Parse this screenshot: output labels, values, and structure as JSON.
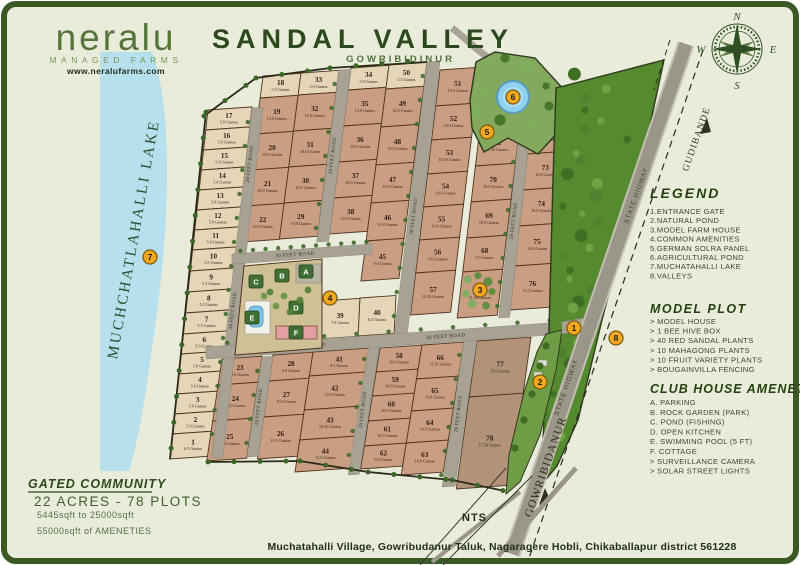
{
  "branding": {
    "logo": "neralu",
    "tagline": "MANAGED FARMS",
    "website": "www.neralufarms.com"
  },
  "header": {
    "title": "SANDAL VALLEY",
    "subtitle": "GOWRIBIDINUR"
  },
  "compass": {
    "n": "N",
    "e": "E",
    "s": "S",
    "w": "W"
  },
  "legend": {
    "heading": "LEGEND",
    "items": [
      "1.ENTRANCE GATE",
      "2.NATURAL POND",
      "3.MODEL FARM HOUSE",
      "4.COMMON AMENITIES",
      "5.GERMAN SOLRA PANEL",
      "6.AGRICULTURAL POND",
      "7.MUCHATAHALLI LAKE",
      "8.VALLEYS"
    ]
  },
  "model_plot": {
    "heading": "MODEL PLOT",
    "items": [
      "> MODEL HOUSE",
      "> 1 BEE HIVE BOX",
      "> 40 RED SANDAL PLANTS",
      "> 10 MAHAGONG PLANTS",
      "> 10 FRUIT VARIETY PLANTS",
      "> BOUGAINVILLA FENCING"
    ]
  },
  "club_house": {
    "heading": "CLUB HOUSE AMENETIES",
    "items": [
      "A. PARKING",
      "B. ROCK GARDEN (PARK)",
      "C. POND (FISHING)",
      "D. OPEN KITCHEN",
      "E. SWIMMING POOL (5 FT)",
      "F. COTTAGE",
      "> SURVEILLANCE CAMERA",
      "> SOLAR STREET LIGHTS"
    ]
  },
  "summary": {
    "heading": "GATED COMMUNITY",
    "line1": "22 ACRES - 78 PLOTS",
    "line2": "5445sqft to 25000sqft",
    "line3": "55000sqft of AMENETIES"
  },
  "footer": {
    "address": "Muchatahalli Village, Gowribudanur Taluk, Nagaragere Hobli, Chikaballapur district 561228"
  },
  "map": {
    "scale_note": "NTS",
    "lake_label": "MUCHCHATLAHALLI LAKE",
    "guntas_suffix": "Guntas",
    "road_labels": {
      "gudibande": "GUDIBANDE",
      "gowribidanur": "GOWRIBIDANUR",
      "state_highway": "STATE HIGWAY"
    },
    "colors": {
      "light": "#e6d6b8",
      "salmon": "#c99e83",
      "brown": "#b29377",
      "road": "#a8a294",
      "lake": "#b7e0ee",
      "forest": "#568a2e",
      "pond_green": "#85a95c",
      "marker": "#f4a81d",
      "border": "#3b5a23"
    },
    "markers": [
      {
        "n": "1",
        "x": 574,
        "y": 328
      },
      {
        "n": "2",
        "x": 540,
        "y": 382
      },
      {
        "n": "3",
        "x": 480,
        "y": 290
      },
      {
        "n": "4",
        "x": 330,
        "y": 298
      },
      {
        "n": "5",
        "x": 487,
        "y": 132
      },
      {
        "n": "6",
        "x": 513,
        "y": 97
      },
      {
        "n": "7",
        "x": 150,
        "y": 257
      },
      {
        "n": "8",
        "x": 616,
        "y": 338
      }
    ],
    "amenity_blocks": [
      {
        "l": "C",
        "x": 256,
        "y": 282
      },
      {
        "l": "B",
        "x": 282,
        "y": 276
      },
      {
        "l": "A",
        "x": 306,
        "y": 272
      },
      {
        "l": "D",
        "x": 296,
        "y": 308
      },
      {
        "l": "E",
        "x": 252,
        "y": 318
      },
      {
        "l": "F",
        "x": 296,
        "y": 333
      }
    ],
    "columns": [
      {
        "x": 208,
        "y": 110,
        "w": 44,
        "lean": -0.11,
        "c": "light",
        "plots": [
          {
            "n": "17",
            "g": "5.0",
            "h": 20
          },
          {
            "n": "16",
            "g": "5.0",
            "h": 20
          },
          {
            "n": "15",
            "g": "5.0",
            "h": 20
          },
          {
            "n": "14",
            "g": "5.0",
            "h": 20
          },
          {
            "n": "13",
            "g": "5.0",
            "h": 20
          },
          {
            "n": "12",
            "g": "5.0",
            "h": 20
          },
          {
            "n": "11",
            "g": "5.0",
            "h": 20
          },
          {
            "n": "10",
            "g": "5.5",
            "h": 21
          },
          {
            "n": "9",
            "g": "5.5",
            "h": 21
          },
          {
            "n": "8",
            "g": "5.5",
            "h": 21
          },
          {
            "n": "7",
            "g": "5.5",
            "h": 21
          },
          {
            "n": "6",
            "g": "5.0",
            "h": 20
          },
          {
            "n": "5",
            "g": "5.0",
            "h": 20
          },
          {
            "n": "4",
            "g": "5.0",
            "h": 20
          },
          {
            "n": "3",
            "g": "5.0",
            "h": 20
          },
          {
            "n": "2",
            "g": "5.0",
            "h": 20
          },
          {
            "n": "1",
            "g": "6.5",
            "h": 25
          }
        ]
      },
      {
        "x": 263,
        "y": 76,
        "w": 38,
        "lean": -0.13,
        "plots": [
          {
            "n": "18",
            "g": "5.5",
            "h": 22,
            "c": "light"
          },
          {
            "n": "19",
            "g": "10.0",
            "h": 36
          },
          {
            "n": "20",
            "g": "10.0",
            "h": 36
          },
          {
            "n": "21",
            "g": "10.0",
            "h": 36
          },
          {
            "n": "22",
            "g": "10.0",
            "h": 36
          }
        ]
      },
      {
        "x": 301,
        "y": 73,
        "w": 38,
        "lean": -0.13,
        "plots": [
          {
            "n": "33",
            "g": "5.0",
            "h": 22,
            "c": "light"
          },
          {
            "n": "32",
            "g": "10.0",
            "h": 36
          },
          {
            "n": "31",
            "g": "10.0",
            "h": 36
          },
          {
            "n": "30",
            "g": "10.0",
            "h": 36
          },
          {
            "n": "29",
            "g": "10.0",
            "h": 36
          }
        ]
      },
      {
        "x": 351,
        "y": 68,
        "w": 38,
        "lean": -0.13,
        "plots": [
          {
            "n": "34",
            "g": "5.0",
            "h": 22,
            "c": "light"
          },
          {
            "n": "35",
            "g": "10.0",
            "h": 36
          },
          {
            "n": "36",
            "g": "10.0",
            "h": 36
          },
          {
            "n": "37",
            "g": "10.0",
            "h": 36
          },
          {
            "n": "38",
            "g": "10.0",
            "h": 36
          }
        ]
      },
      {
        "x": 389,
        "y": 65,
        "w": 38,
        "lean": -0.13,
        "plots": [
          {
            "n": "50",
            "g": "5.5",
            "h": 24,
            "c": "light"
          },
          {
            "n": "49",
            "g": "10.0",
            "h": 38
          },
          {
            "n": "48",
            "g": "10.0",
            "h": 38
          },
          {
            "n": "47",
            "g": "10.0",
            "h": 38
          },
          {
            "n": "46",
            "g": "10.0",
            "h": 38
          },
          {
            "n": "45",
            "g": "9.0",
            "h": 40
          }
        ]
      },
      {
        "x": 440,
        "y": 70,
        "w": 40,
        "lean": -0.12,
        "plots": [
          {
            "n": "51",
            "g": "10.0",
            "h": 36
          },
          {
            "n": "52",
            "g": "10.0",
            "h": 34
          },
          {
            "n": "53",
            "g": "10.50",
            "h": 34
          },
          {
            "n": "54",
            "g": "10.0",
            "h": 33
          },
          {
            "n": "55",
            "g": "10.0",
            "h": 33
          },
          {
            "n": "56",
            "g": "10.0",
            "h": 33
          },
          {
            "n": "57",
            "g": "12.20",
            "h": 42
          }
        ]
      },
      {
        "x": 480,
        "y": 128,
        "w": 40,
        "lean": -0.12,
        "plots": [
          {
            "n": "71",
            "g": "7.30",
            "h": 38
          },
          {
            "n": "70",
            "g": "10.0",
            "h": 36
          },
          {
            "n": "69",
            "g": "10.0",
            "h": 36
          },
          {
            "n": "68",
            "g": "9.5",
            "h": 34
          },
          {
            "n": "67",
            "g": "11.50",
            "h": 46,
            "trees": true
          }
        ]
      },
      {
        "x": 531,
        "y": 120,
        "w": 40,
        "lean": -0.11,
        "plots": [
          {
            "n": "72",
            "g": "5.5",
            "h": 34
          },
          {
            "n": "73",
            "g": "10.0",
            "h": 36
          },
          {
            "n": "74",
            "g": "10.0",
            "h": 36
          },
          {
            "n": "75",
            "g": "14.0",
            "h": 40
          },
          {
            "n": "76",
            "g": "13.5",
            "h": 44
          }
        ]
      },
      {
        "x": 222,
        "y": 359,
        "w": 40,
        "lean": -0.15,
        "plots": [
          {
            "n": "23",
            "g": "9.0",
            "h": 26
          },
          {
            "n": "24",
            "g": "10.0",
            "h": 36
          },
          {
            "n": "25",
            "g": "12.0",
            "h": 40
          }
        ]
      },
      {
        "x": 273,
        "y": 355,
        "w": 40,
        "lean": -0.15,
        "plots": [
          {
            "n": "28",
            "g": "9.0",
            "h": 26
          },
          {
            "n": "27",
            "g": "10.0",
            "h": 36
          },
          {
            "n": "26",
            "g": "13.0",
            "h": 42
          }
        ]
      },
      {
        "x": 313,
        "y": 352,
        "w": 56,
        "lean": -0.15,
        "plots": [
          {
            "n": "41",
            "g": "8.5",
            "h": 24
          },
          {
            "n": "42",
            "g": "12.0",
            "h": 34
          },
          {
            "n": "43",
            "g": "10.50",
            "h": 30
          },
          {
            "n": "44",
            "g": "11.0",
            "h": 32
          }
        ]
      },
      {
        "x": 380,
        "y": 348,
        "w": 42,
        "lean": -0.16,
        "plots": [
          {
            "n": "58",
            "g": "10.0",
            "h": 24
          },
          {
            "n": "59",
            "g": "10.0",
            "h": 24
          },
          {
            "n": "60",
            "g": "10.0",
            "h": 25
          },
          {
            "n": "61",
            "g": "10.0",
            "h": 25
          },
          {
            "n": "62",
            "g": "9.0",
            "h": 23
          }
        ]
      },
      {
        "x": 422,
        "y": 345,
        "w": 42,
        "lean": -0.16,
        "plots": [
          {
            "n": "66",
            "g": "12.50",
            "h": 34
          },
          {
            "n": "65",
            "g": "10.0",
            "h": 32
          },
          {
            "n": "64",
            "g": "10.0",
            "h": 32
          },
          {
            "n": "63",
            "g": "10.0",
            "h": 32
          }
        ]
      },
      {
        "x": 477,
        "y": 341,
        "w": 54,
        "lean": -0.14,
        "c": "brown",
        "plots": [
          {
            "n": "77",
            "g": "25.0",
            "h": 56
          },
          {
            "n": "78",
            "g": "17.50",
            "h": 92
          }
        ]
      },
      {
        "x": 322,
        "y": 301,
        "w": 38,
        "lean": -0.05,
        "plots": [
          {
            "n": "39",
            "g": "7.0",
            "h": 38,
            "c": "light"
          }
        ]
      },
      {
        "x": 360,
        "y": 298,
        "w": 36,
        "lean": -0.05,
        "plots": [
          {
            "n": "40",
            "g": "6.5",
            "h": 38,
            "c": "light"
          }
        ]
      }
    ],
    "vroads": [
      {
        "x": 252,
        "y": 108,
        "w": 11,
        "len": 350,
        "lean": -0.115,
        "labels": [
          {
            "t": "20 FEET ROAD",
            "at": 0.16
          },
          {
            "t": "30 FEET ROAD",
            "at": 0.58
          }
        ]
      },
      {
        "x": 339,
        "y": 70,
        "w": 12,
        "len": 172,
        "lean": -0.13,
        "labels": [
          {
            "t": "20 FEET ROAD",
            "at": 0.5
          }
        ]
      },
      {
        "x": 427,
        "y": 62,
        "w": 13,
        "len": 276,
        "lean": -0.12,
        "labels": [
          {
            "t": "30 FEET ROAD",
            "at": 0.56
          }
        ]
      },
      {
        "x": 520,
        "y": 124,
        "w": 11,
        "len": 194,
        "lean": -0.11,
        "labels": [
          {
            "t": "20 FEET ROAD",
            "at": 0.5
          }
        ]
      },
      {
        "x": 262,
        "y": 357,
        "w": 11,
        "len": 100,
        "lean": -0.15,
        "labels": [
          {
            "t": "20 FEET ROAD",
            "at": 0.5
          }
        ]
      },
      {
        "x": 369,
        "y": 345,
        "w": 11,
        "len": 130,
        "lean": -0.16,
        "labels": [
          {
            "t": "20 FEET ROAD",
            "at": 0.5
          }
        ]
      },
      {
        "x": 464,
        "y": 341,
        "w": 13,
        "len": 146,
        "lean": -0.15,
        "labels": [
          {
            "t": "20 FEET ROAD",
            "at": 0.5
          }
        ]
      }
    ],
    "hroads": [
      {
        "x1": 206,
        "y1": 347,
        "x2": 564,
        "y2": 322,
        "w": 12,
        "labels": [
          {
            "t": "30 FEET ROAD",
            "at": 0.28
          },
          {
            "t": "30 FEET ROAD",
            "at": 0.67
          }
        ]
      },
      {
        "x1": 232,
        "y1": 254,
        "x2": 372,
        "y2": 244,
        "w": 10,
        "labels": [
          {
            "t": "30 FEET ROAD",
            "at": 0.45
          }
        ]
      }
    ]
  }
}
